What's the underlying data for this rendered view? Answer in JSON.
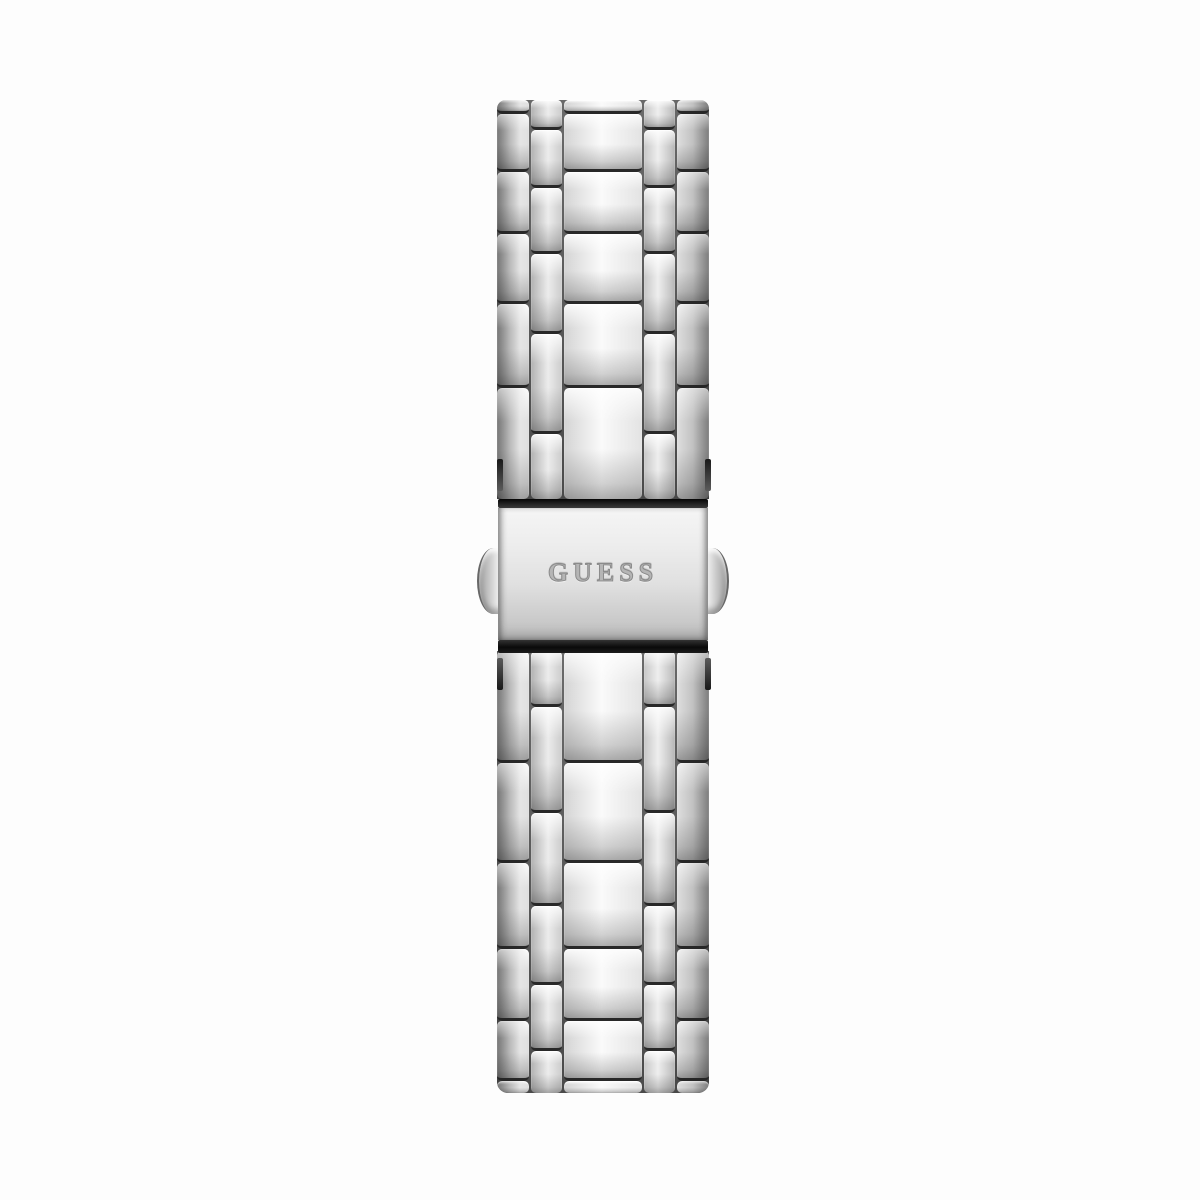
{
  "scene": {
    "description": "Back view product photo of a silver stainless-steel five-row link watch bracelet with a folding clasp",
    "background_color": "#fdfdfd"
  },
  "clasp": {
    "engraving": "GUESS",
    "bar_color": "#1a1a1a",
    "plate_highlight_color": "#f5f5f5",
    "plate_shadow_color": "#bfbfbf"
  },
  "bracelet": {
    "metal_colors": {
      "highlight": "#fafafa",
      "mid": "#d9d9d9",
      "shadow": "#8f8f8f",
      "separator": "#282828"
    },
    "geometry": {
      "top_section": {
        "wide_rows": [
          14,
          58,
          62,
          70,
          84,
          111
        ],
        "narrow_rows": [
          30,
          58,
          66,
          80,
          100,
          65
        ]
      },
      "bottom_section": {
        "wide_rows": [
          112,
          100,
          86,
          72,
          60,
          12
        ],
        "narrow_rows": [
          56,
          106,
          93,
          79,
          66,
          42
        ]
      }
    }
  }
}
